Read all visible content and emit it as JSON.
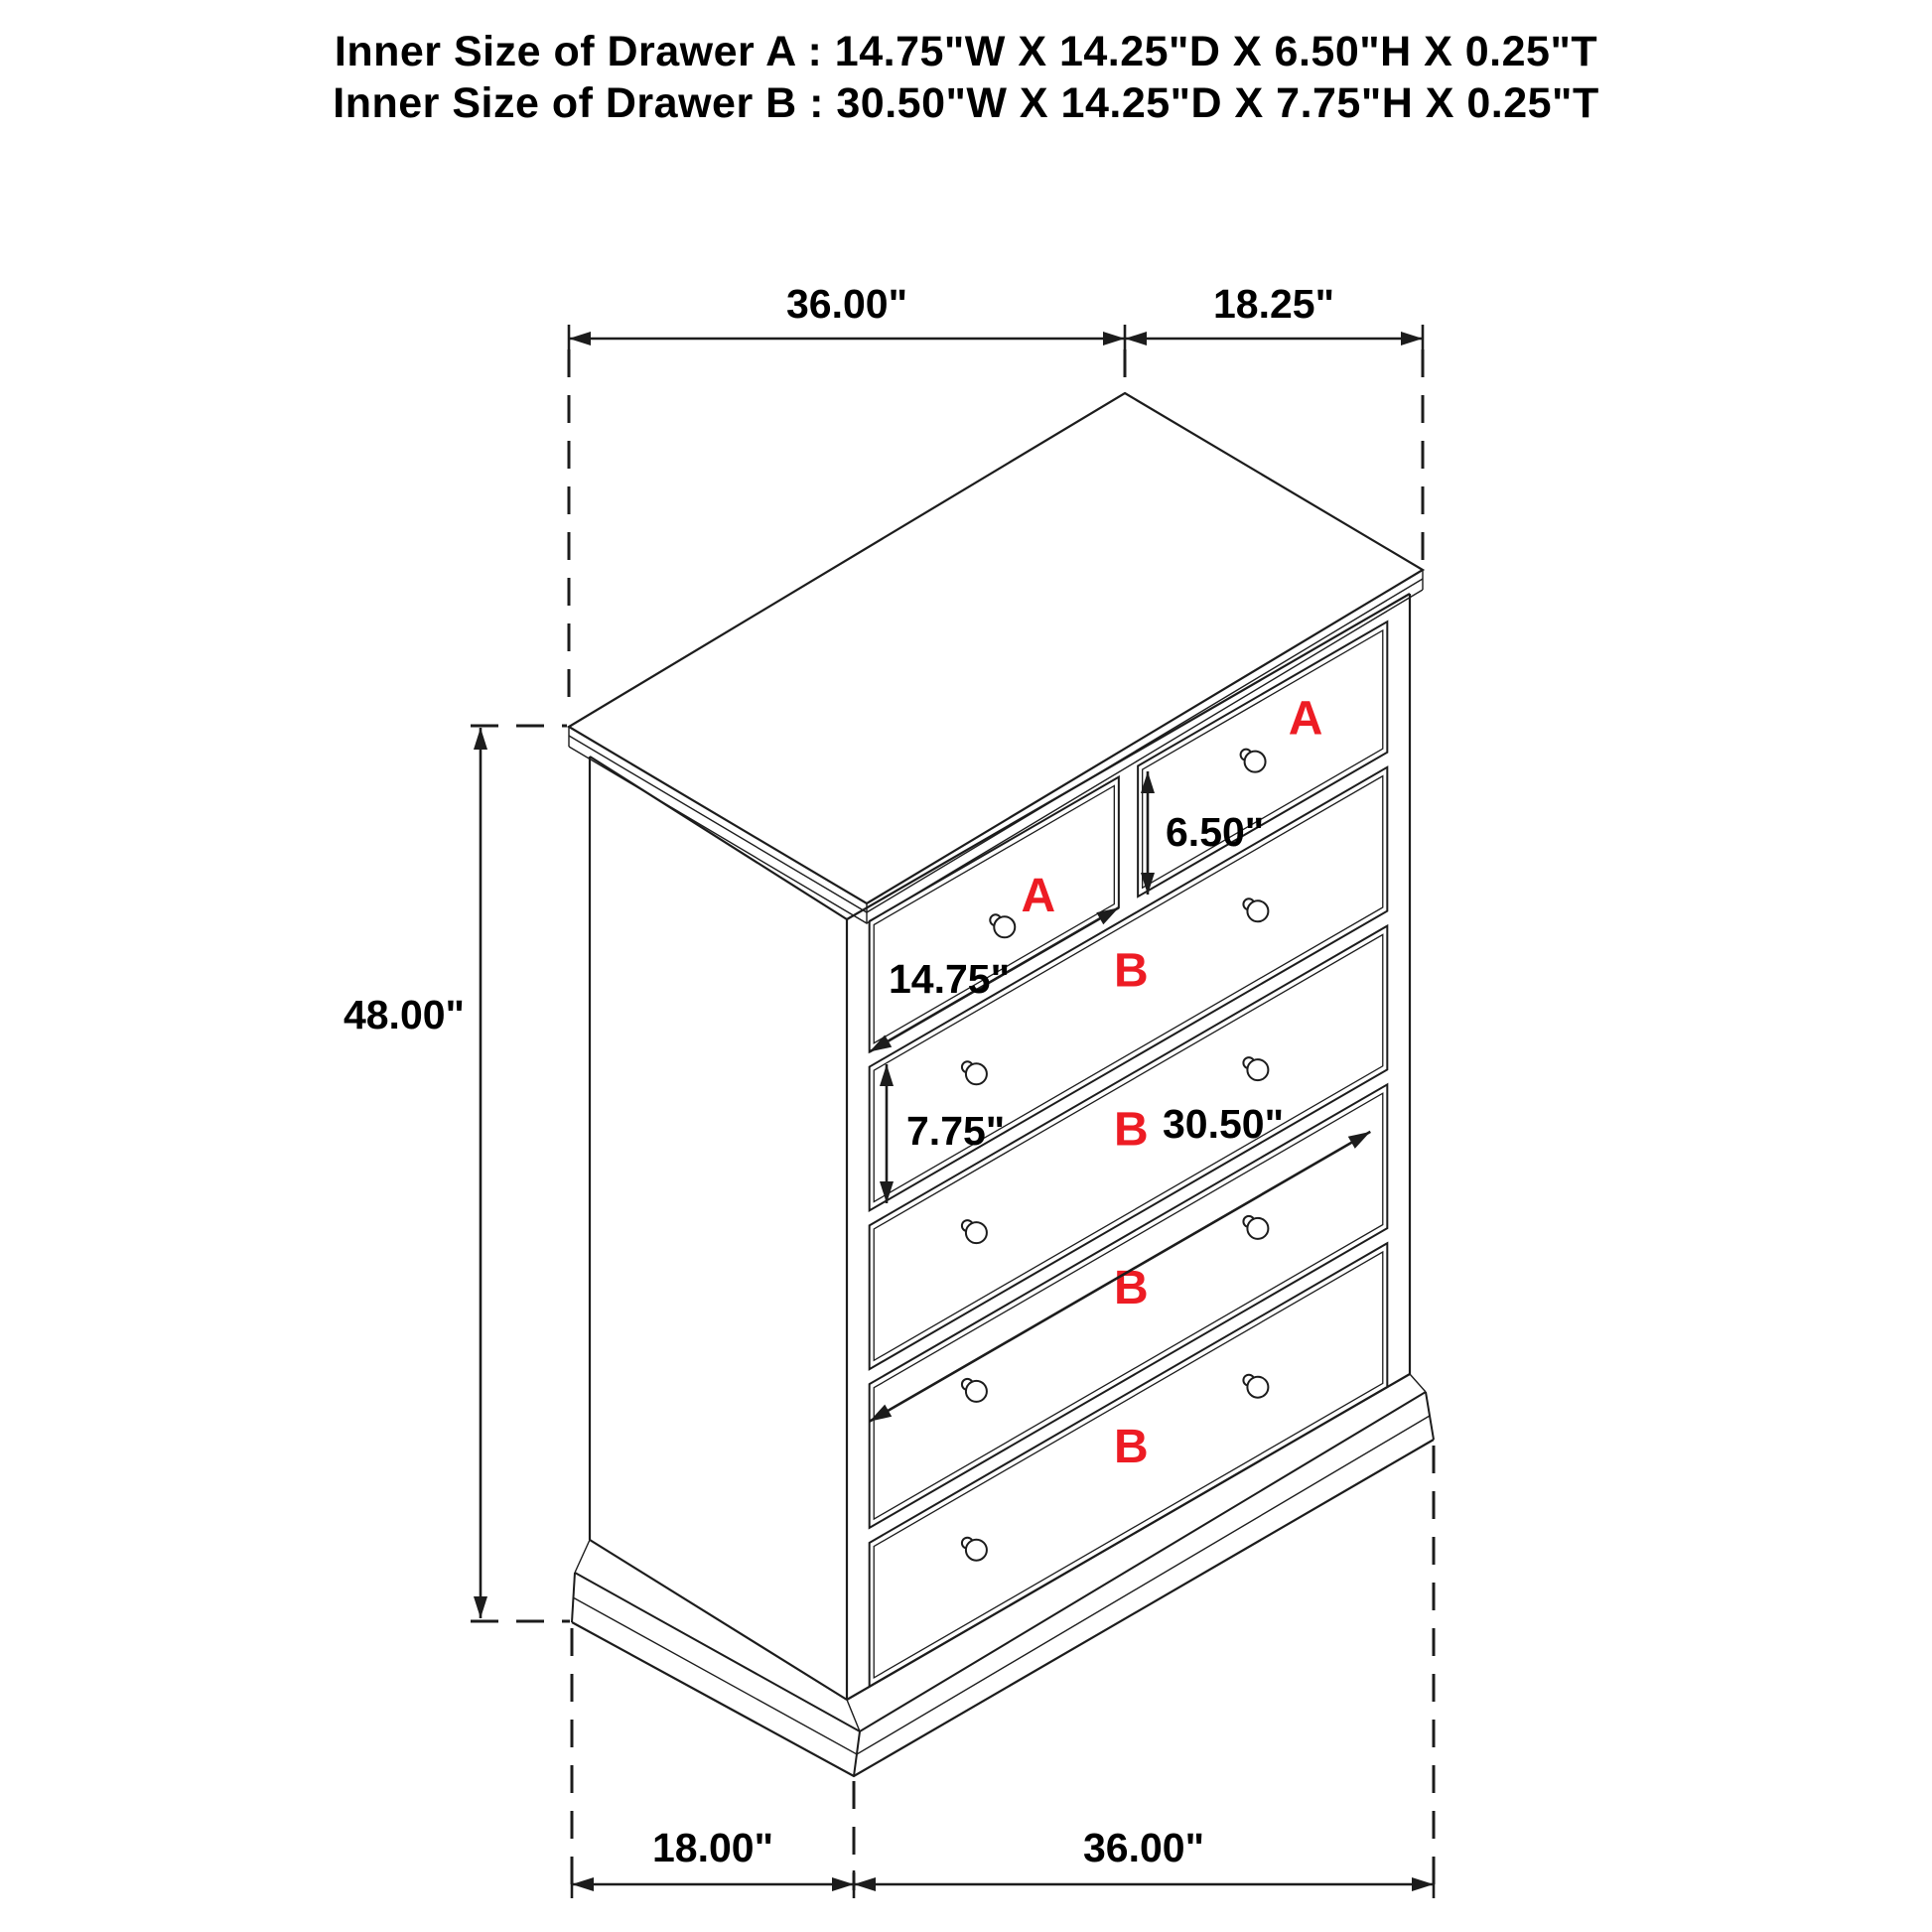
{
  "header": {
    "line1": "Inner Size of Drawer A : 14.75\"W X 14.25\"D X 6.50\"H X 0.25\"T",
    "line2": "Inner Size of Drawer B : 30.50\"W X 14.25\"D X 7.75\"H X 0.25\"T"
  },
  "diagram": {
    "type": "isometric furniture dimension drawing",
    "subject": "chest of drawers with 2 small drawers (A) and 4 wide drawers (B)",
    "dimensions": {
      "top_width": "36.00\"",
      "top_depth": "18.25\"",
      "height": "48.00\"",
      "drawer_a_height": "6.50\"",
      "drawer_a_width": "14.75\"",
      "drawer_b_height": "7.75\"",
      "drawer_b_width": "30.50\"",
      "floor_depth": "18.00\"",
      "floor_width": "36.00\""
    },
    "drawer_labels": {
      "a_left": "A",
      "a_right": "A",
      "b1": "B",
      "b2": "B",
      "b3": "B",
      "b4": "B"
    },
    "colors": {
      "line": "#1c1c1c",
      "drawer_label": "#ed1c24",
      "text": "#000000",
      "background": "#ffffff"
    }
  }
}
